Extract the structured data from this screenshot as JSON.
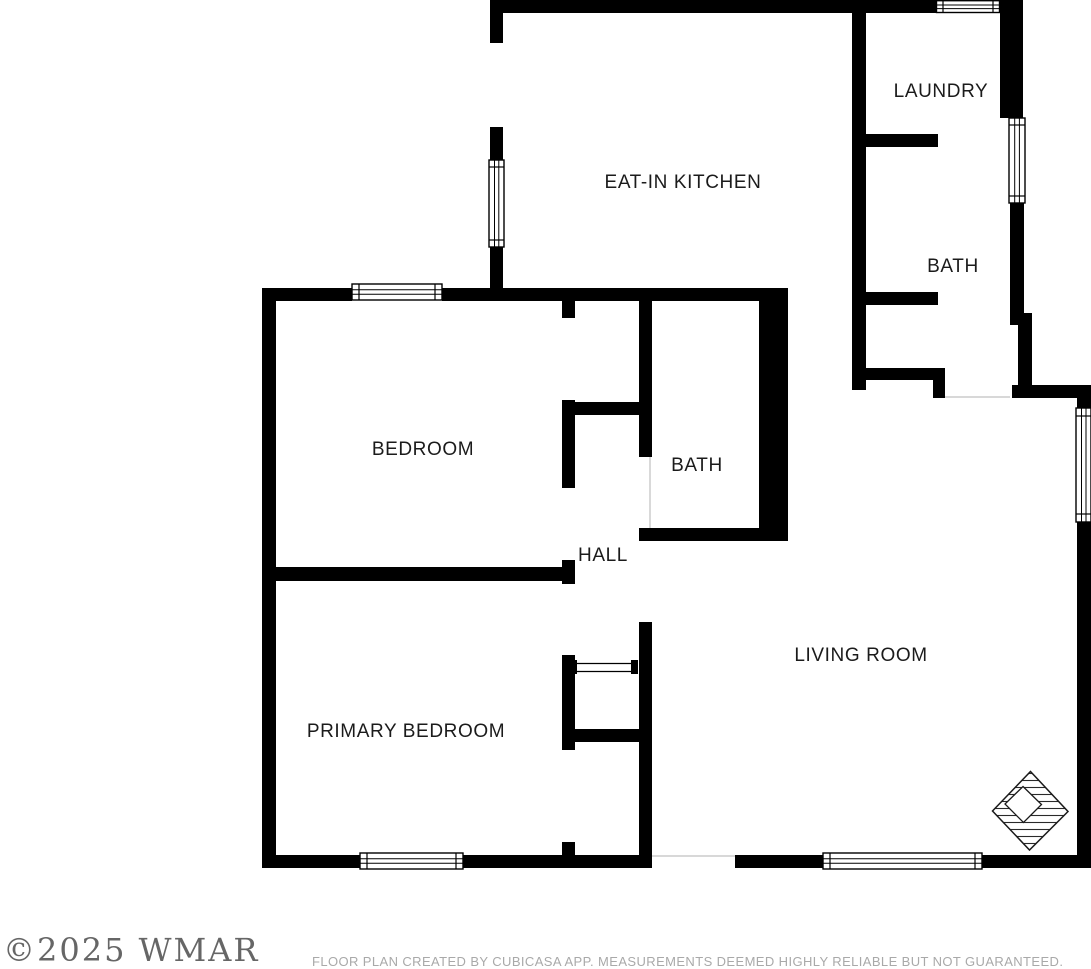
{
  "floor_plan": {
    "rooms": {
      "eat_in_kitchen": {
        "label": "EAT-IN KITCHEN"
      },
      "laundry": {
        "label": "LAUNDRY"
      },
      "bath_upper": {
        "label": "BATH"
      },
      "bedroom": {
        "label": "BEDROOM"
      },
      "bath_center": {
        "label": "BATH"
      },
      "hall": {
        "label": "HALL"
      },
      "living_room": {
        "label": "LIVING ROOM"
      },
      "primary_bedroom": {
        "label": "PRIMARY BEDROOM"
      }
    },
    "colors": {
      "wall": "#000000",
      "floor": "#ffffff",
      "label": "#1b1b1b",
      "threshold": "#cccccc"
    },
    "icons": {
      "compass": "north-indicator-icon"
    }
  },
  "footer": {
    "watermark": "©2025 WMAR",
    "disclaimer": "FLOOR PLAN CREATED BY CUBICASA APP. MEASUREMENTS DEEMED HIGHLY RELIABLE BUT NOT GUARANTEED."
  }
}
